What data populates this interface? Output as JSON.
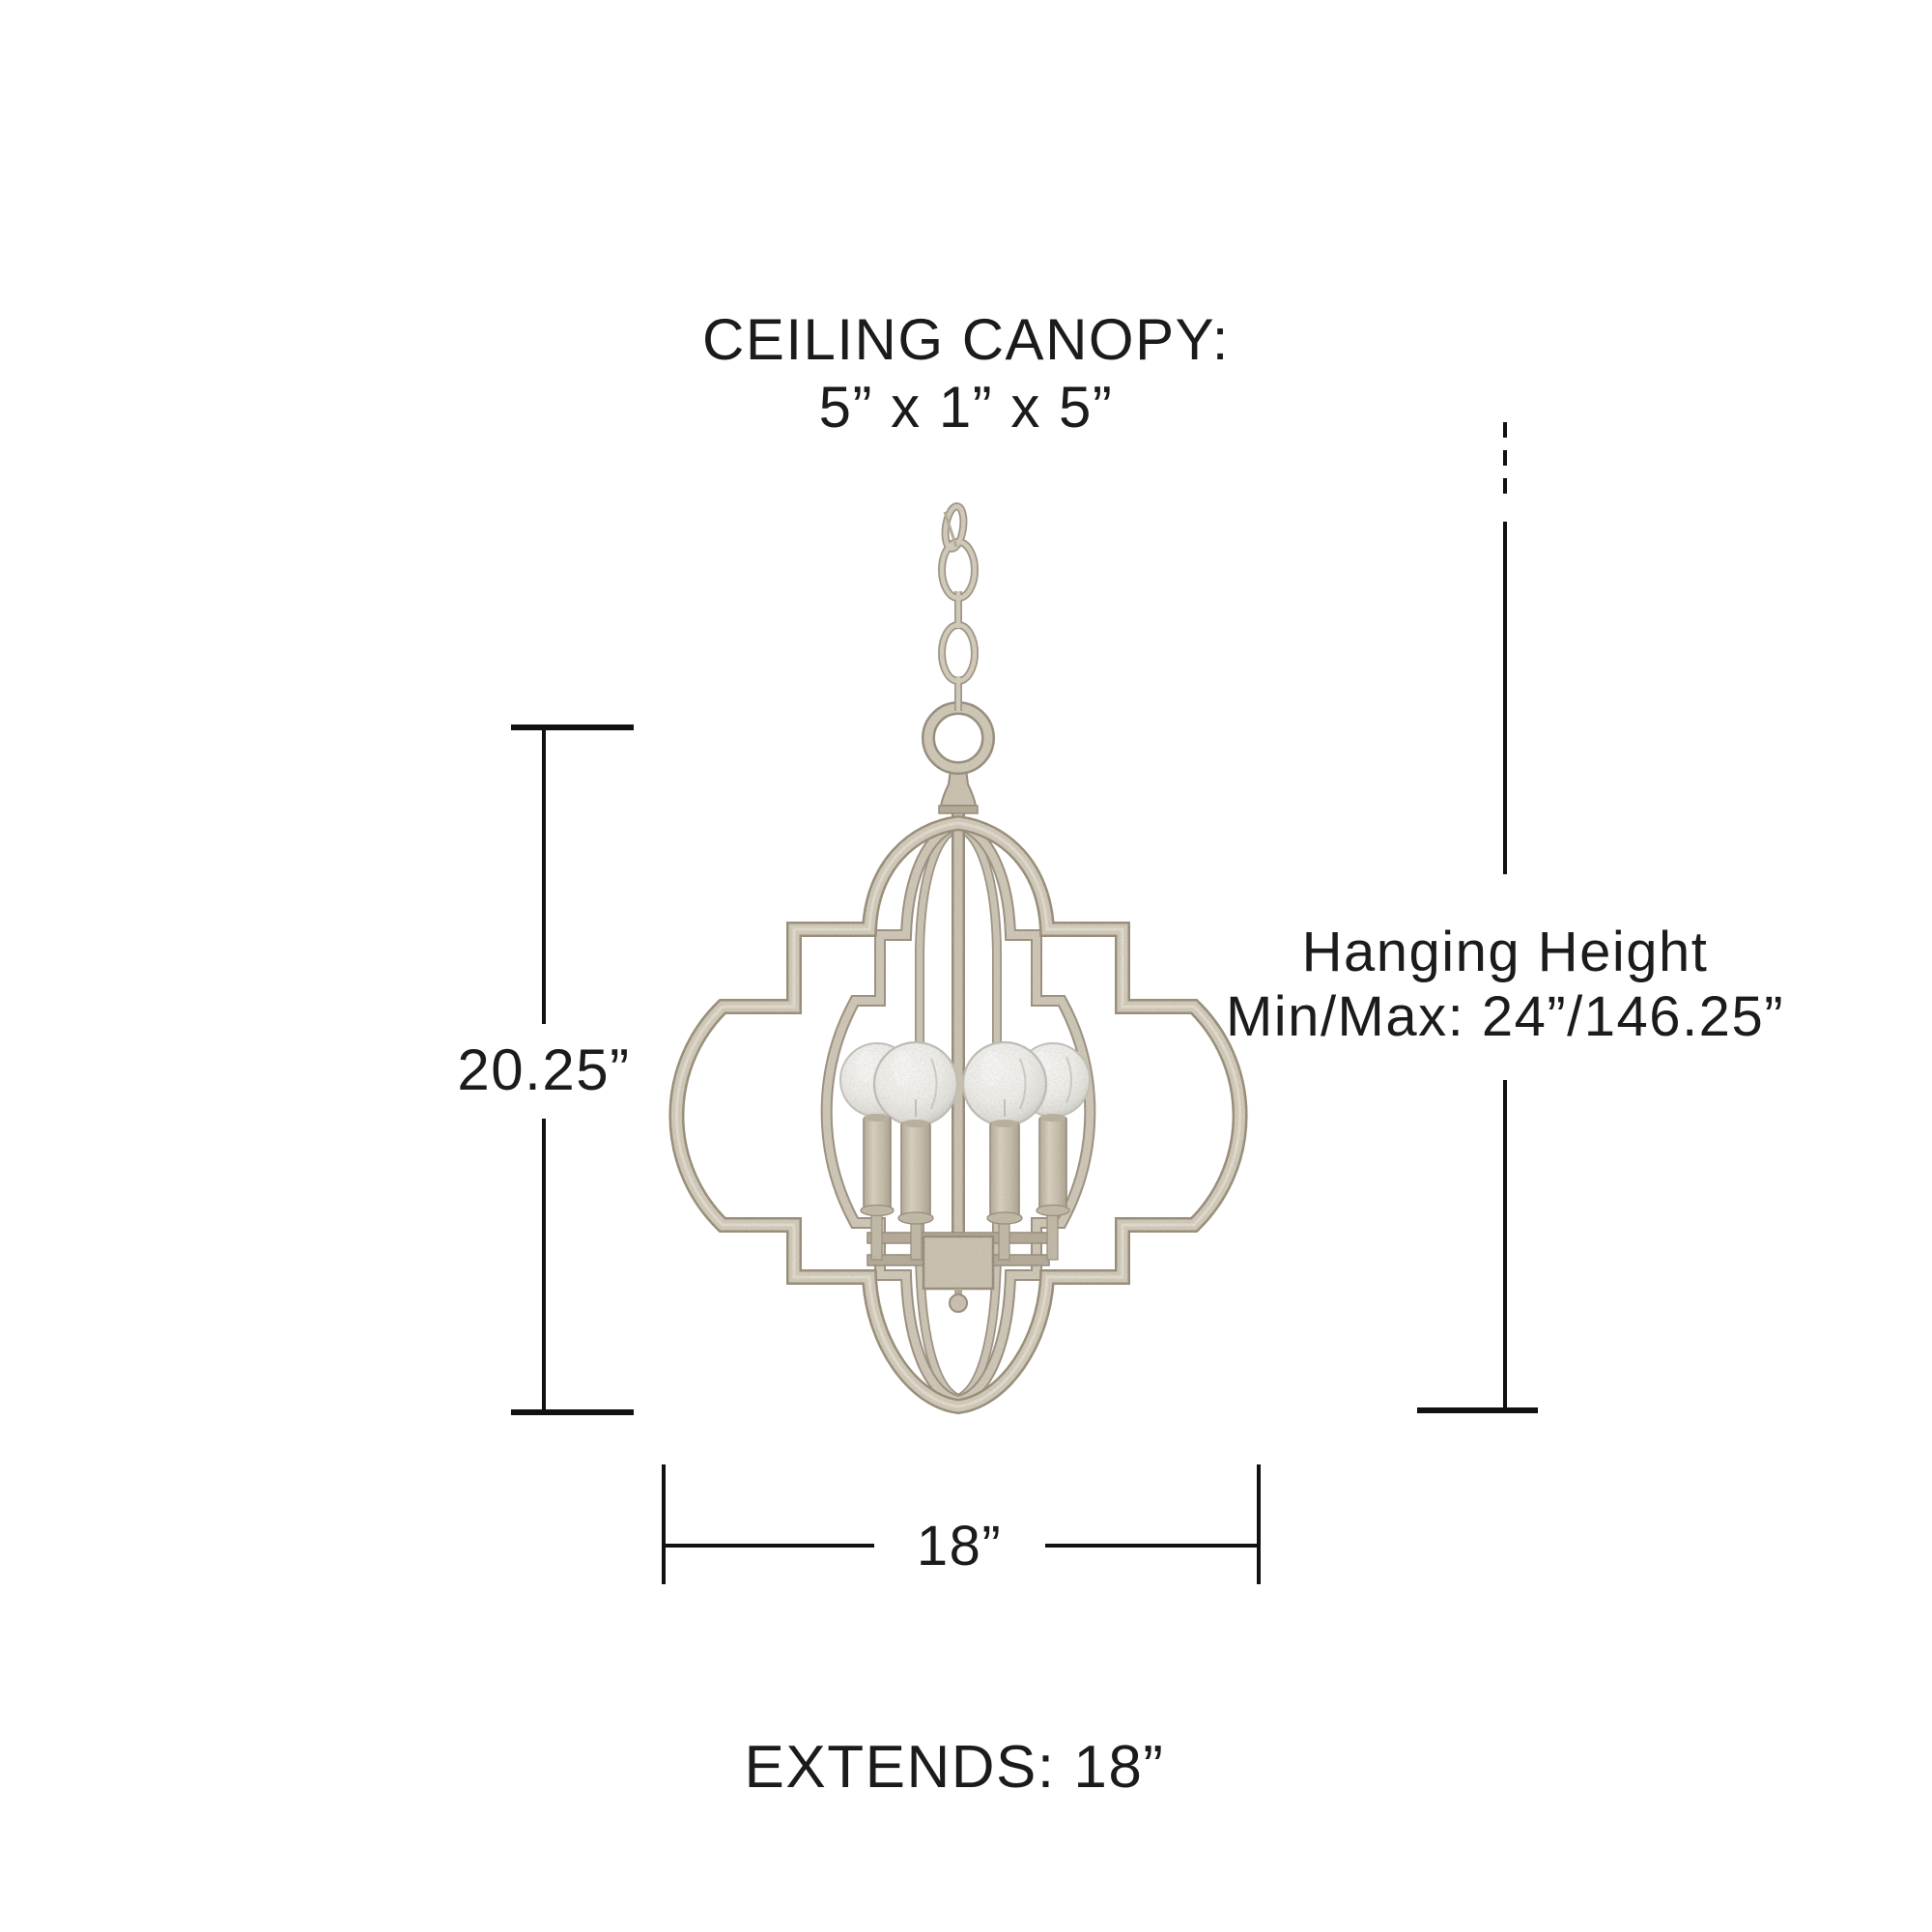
{
  "diagram": {
    "title_block": {
      "line1": "CEILING CANOPY:",
      "line2": "5” x 1” x 5”"
    },
    "hanging_block": {
      "line1": "Hanging Height",
      "line2": "Min/Max: 24”/146.25”"
    },
    "fixture_height_label": "20.25”",
    "fixture_width_label": "18”",
    "extends_label": "EXTENDS: 18”",
    "light_count": 4,
    "colors": {
      "background": "#ffffff",
      "text": "#1b1b1b",
      "dimension_line": "#111111",
      "metal_edge": "#9a9080",
      "metal_fill": "#d5cebd",
      "metal_highlight": "#ece7db",
      "bulb_glass_rim": "#c4c4bf",
      "bulb_glass_center": "#ffffff"
    }
  }
}
